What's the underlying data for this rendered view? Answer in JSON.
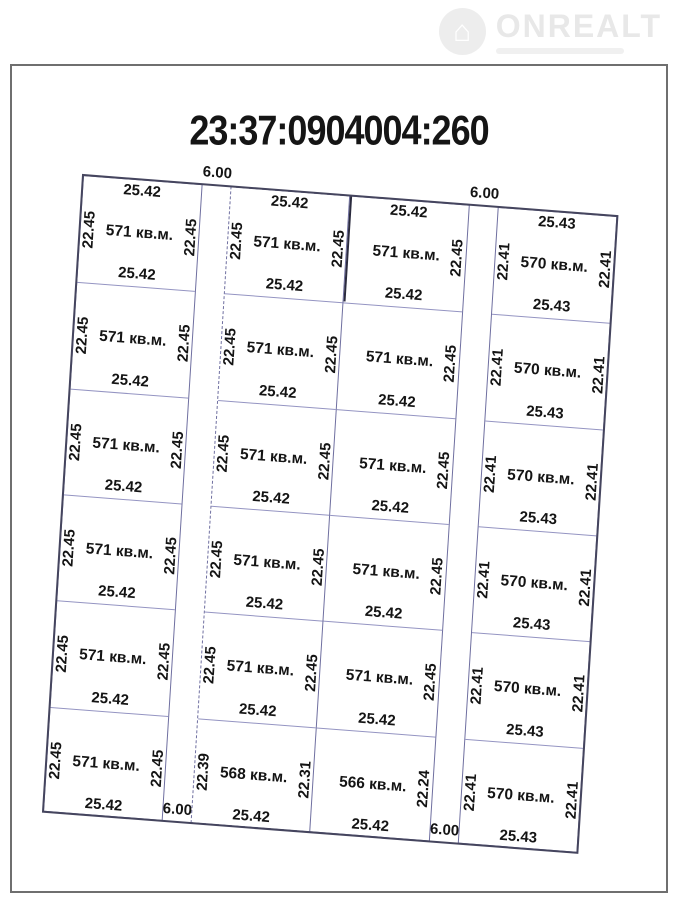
{
  "logo": {
    "brand": "ONREALT",
    "icon": "house-icon"
  },
  "title": "23:37:0904004:260",
  "plan": {
    "columns": [
      {
        "edge_labels": [
          "25.42",
          "25.42",
          "25.42",
          "25.42",
          "25.42",
          "25.42",
          "25.42"
        ],
        "rows": [
          {
            "area": "571 кв.м.",
            "left": "22.45",
            "right": "22.45"
          },
          {
            "area": "571 кв.м.",
            "left": "22.45",
            "right": "22.45"
          },
          {
            "area": "571 кв.м.",
            "left": "22.45",
            "right": "22.45"
          },
          {
            "area": "571 кв.м.",
            "left": "22.45",
            "right": "22.45"
          },
          {
            "area": "571 кв.м.",
            "left": "22.45",
            "right": "22.45"
          },
          {
            "area": "571 кв.м.",
            "left": "22.45",
            "right": "22.45"
          }
        ]
      },
      {
        "edge_labels": [
          "25.42",
          "25.42",
          "25.42",
          "25.42",
          "25.42",
          "25.42",
          "25.42"
        ],
        "rows": [
          {
            "area": "571 кв.м.",
            "left": "22.45",
            "right": "22.45"
          },
          {
            "area": "571 кв.м.",
            "left": "22.45",
            "right": "22.45"
          },
          {
            "area": "571 кв.м.",
            "left": "22.45",
            "right": "22.45"
          },
          {
            "area": "571 кв.м.",
            "left": "22.45",
            "right": "22.45"
          },
          {
            "area": "571 кв.м.",
            "left": "22.45",
            "right": "22.45"
          },
          {
            "area": "568 кв.м.",
            "left": "22.39",
            "right": "22.31"
          }
        ]
      },
      {
        "edge_labels": [
          "25.42",
          "25.42",
          "25.42",
          "25.42",
          "25.42",
          "25.42",
          "25.42"
        ],
        "rows": [
          {
            "area": "571 кв.м.",
            "left": null,
            "right": "22.45"
          },
          {
            "area": "571 кв.м.",
            "left": null,
            "right": "22.45"
          },
          {
            "area": "571 кв.м.",
            "left": null,
            "right": "22.45"
          },
          {
            "area": "571 кв.м.",
            "left": null,
            "right": "22.45"
          },
          {
            "area": "571 кв.м.",
            "left": null,
            "right": "22.45"
          },
          {
            "area": "566 кв.м.",
            "left": null,
            "right": "22.24"
          }
        ]
      },
      {
        "edge_labels": [
          "25.43",
          "25.43",
          "25.43",
          "25.43",
          "25.43",
          "25.43",
          "25.43"
        ],
        "rows": [
          {
            "area": "570 кв.м.",
            "left": "22.41",
            "right": "22.41"
          },
          {
            "area": "570 кв.м.",
            "left": "22.41",
            "right": "22.41"
          },
          {
            "area": "570 кв.м.",
            "left": "22.41",
            "right": "22.41"
          },
          {
            "area": "570 кв.м.",
            "left": "22.41",
            "right": "22.41"
          },
          {
            "area": "570 кв.м.",
            "left": "22.41",
            "right": "22.41"
          },
          {
            "area": "570 кв.м.",
            "left": "22.41",
            "right": "22.41"
          }
        ]
      }
    ],
    "roads": [
      {
        "top_label": "6.00",
        "bottom_label": "6.00"
      },
      {
        "top_label": "6.00",
        "bottom_label": "6.00"
      }
    ]
  }
}
